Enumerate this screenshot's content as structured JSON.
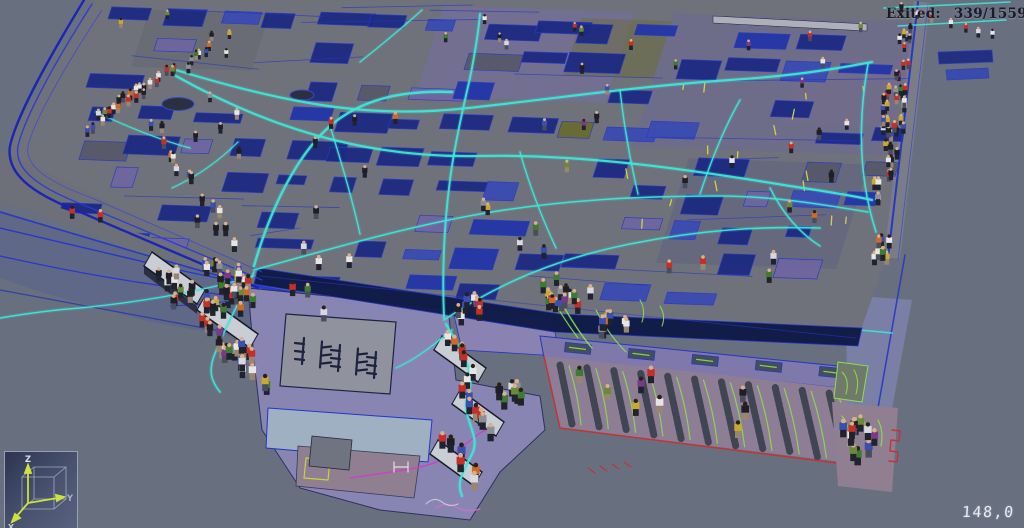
{
  "hud": {
    "exited_label": "Exited:",
    "exited_value": "339/1559",
    "time": "148,0"
  },
  "counts": {
    "exited": 339,
    "total": 1559
  },
  "axis_gizmo": {
    "z_label": "Z",
    "y_label": "Y",
    "x_label": "X"
  },
  "colors": {
    "bg": "#68707f",
    "floor": "#6f717b",
    "walk_terrace": "#6d6f79",
    "slab_navy": "#1c2a82",
    "slab_blue": "#3a4cb2",
    "slab_gray": "#57596a",
    "slab_purple": "#6e66a0",
    "outline_blue": "#2236c8",
    "trim_navy": "#1822b8",
    "band_navy": "#101a48",
    "mezz": "#5f6886",
    "mezz_trail": "#2133d4",
    "trail_cyan": "#3ee6d6",
    "trail_green": "#8ce04a",
    "trail_magenta": "#cf3ec9",
    "lower_purple": "#8b86b4",
    "room_gray": "#90939e",
    "room_pale": "#9fb0c2",
    "room_mauve": "#8f7f90",
    "cafeteria": "#8d7e95",
    "cafeteria_strip": "#7f78aa",
    "seat_dark": "#3a404d",
    "red_line": "#c83030",
    "escalator": "#c9cdd4",
    "yellow_mark": "#d6da3c",
    "beam_light": "#b4b8c0",
    "hud_text": "#1b1b28",
    "time_text": "#e8ebf2",
    "axis_arrow": "#cde23e",
    "gizmo_border": "#98a0b4"
  }
}
